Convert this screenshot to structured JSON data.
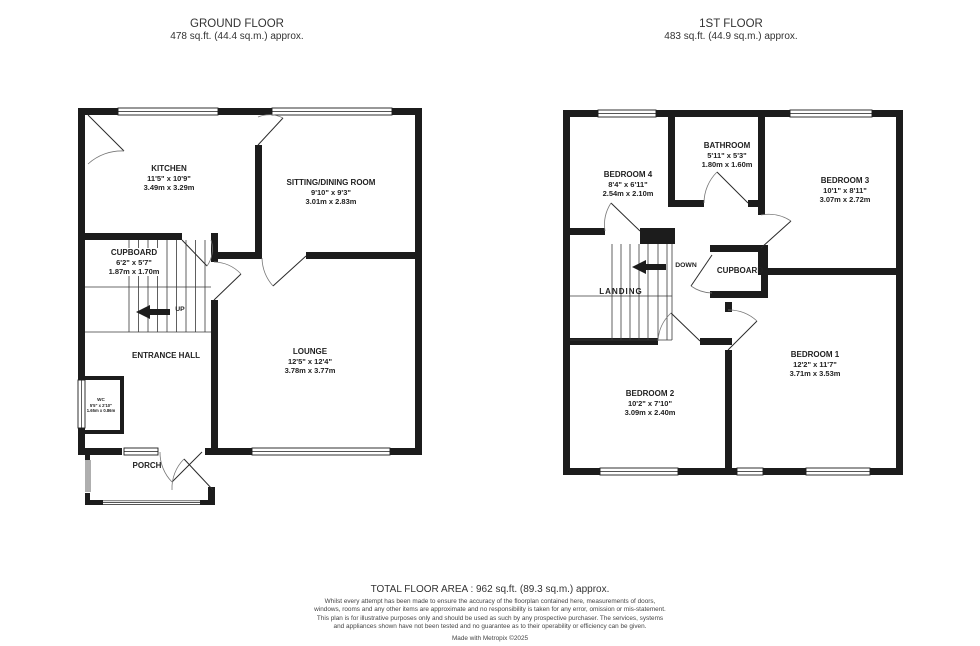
{
  "ground_floor": {
    "title": "GROUND FLOOR",
    "area": "478 sq.ft. (44.4 sq.m.) approx.",
    "rooms": {
      "kitchen": {
        "name": "KITCHEN",
        "imperial": "11'5\" x 10'9\"",
        "metric": "3.49m x 3.29m"
      },
      "sitting_dining": {
        "name": "SITTING/DINING ROOM",
        "imperial": "9'10\" x 9'3\"",
        "metric": "3.01m x 2.83m"
      },
      "cupboard": {
        "name": "CUPBOARD",
        "imperial": "6'2\" x 5'7\"",
        "metric": "1.87m x 1.70m"
      },
      "entrance_hall": {
        "name": "ENTRANCE HALL"
      },
      "lounge": {
        "name": "LOUNGE",
        "imperial": "12'5\" x 12'4\"",
        "metric": "3.78m x 3.77m"
      },
      "wc": {
        "name": "WC",
        "imperial": "5'5\" x 2'10\"",
        "metric": "1.65m x 0.86m"
      },
      "porch": {
        "name": "PORCH"
      }
    },
    "stairs_label": "UP"
  },
  "first_floor": {
    "title": "1ST FLOOR",
    "area": "483 sq.ft. (44.9 sq.m.) approx.",
    "rooms": {
      "bedroom4": {
        "name": "BEDROOM 4",
        "imperial": "8'4\" x 6'11\"",
        "metric": "2.54m x 2.10m"
      },
      "bathroom": {
        "name": "BATHROOM",
        "imperial": "5'11\" x 5'3\"",
        "metric": "1.80m x 1.60m"
      },
      "bedroom3": {
        "name": "BEDROOM 3",
        "imperial": "10'1\" x 8'11\"",
        "metric": "3.07m x 2.72m"
      },
      "landing": {
        "name": "LANDING"
      },
      "cupboard": {
        "name": "CUPBOARD"
      },
      "bedroom1": {
        "name": "BEDROOM 1",
        "imperial": "12'2\" x 11'7\"",
        "metric": "3.71m x 3.53m"
      },
      "bedroom2": {
        "name": "BEDROOM 2",
        "imperial": "10'2\" x 7'10\"",
        "metric": "3.09m x 2.40m"
      }
    },
    "stairs_label": "DOWN"
  },
  "footer": {
    "total_area": "TOTAL FLOOR AREA : 962 sq.ft. (89.3 sq.m.) approx.",
    "disclaimer": "Whilst every attempt has been made to ensure the accuracy of the floorplan contained here, measurements of doors, windows, rooms and any other items are approximate and no responsibility is taken for any error, omission or mis-statement. This plan is for illustrative purposes only and should be used as such by any prospective purchaser. The services, systems and appliances shown have not been tested and no guarantee as to their operability or efficiency can be given.",
    "credit": "Made with Metropix ©2025"
  }
}
